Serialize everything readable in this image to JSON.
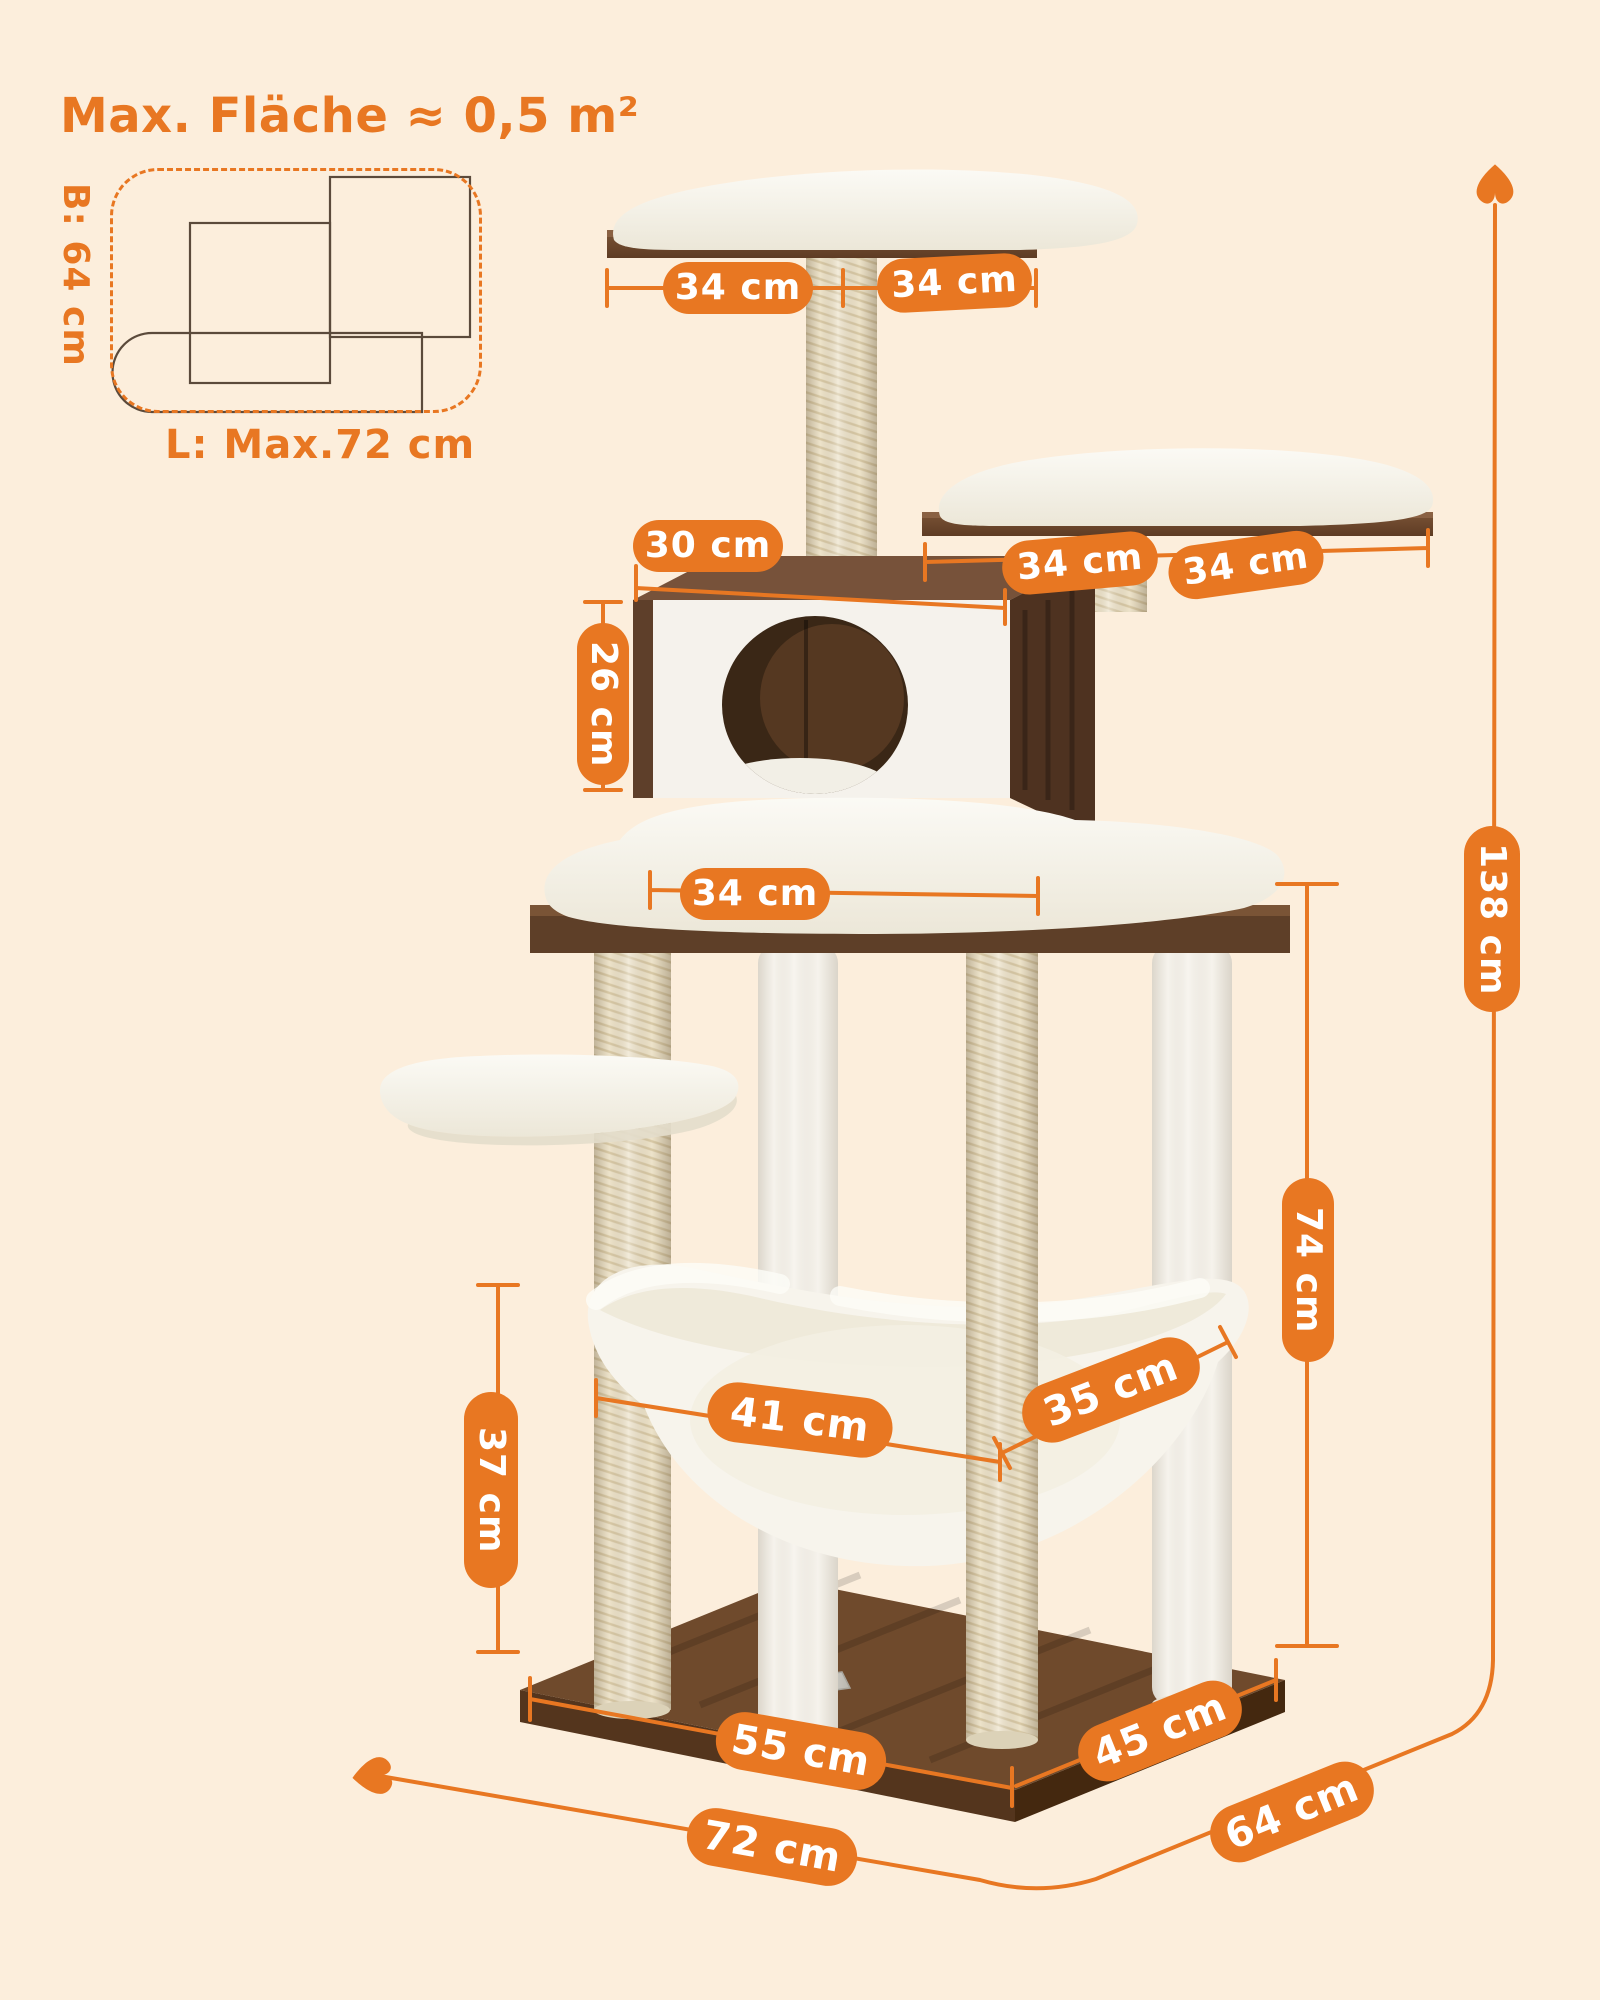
{
  "colors": {
    "background": "#FCEEDC",
    "accent": "#E87722",
    "pill_text": "#FFFFFF"
  },
  "area_diagram": {
    "title": "Max. Fläche ≈ 0,5 m²",
    "width_label": "B: 64 cm",
    "length_label": "L: Max.72 cm"
  },
  "dimensions": {
    "top_platform_left": "34 cm",
    "top_platform_right": "34 cm",
    "condo_width": "30 cm",
    "condo_height": "26 cm",
    "tier2_platform_left": "34 cm",
    "tier2_platform_right": "34 cm",
    "middle_platform_width": "34 cm",
    "upper_section_height": "74 cm",
    "total_height": "138 cm",
    "hammock_width": "41 cm",
    "hammock_depth": "35 cm",
    "hammock_clearance": "37 cm",
    "base_length": "55 cm",
    "base_depth": "45 cm",
    "floor_length": "72 cm",
    "floor_depth": "64 cm"
  }
}
